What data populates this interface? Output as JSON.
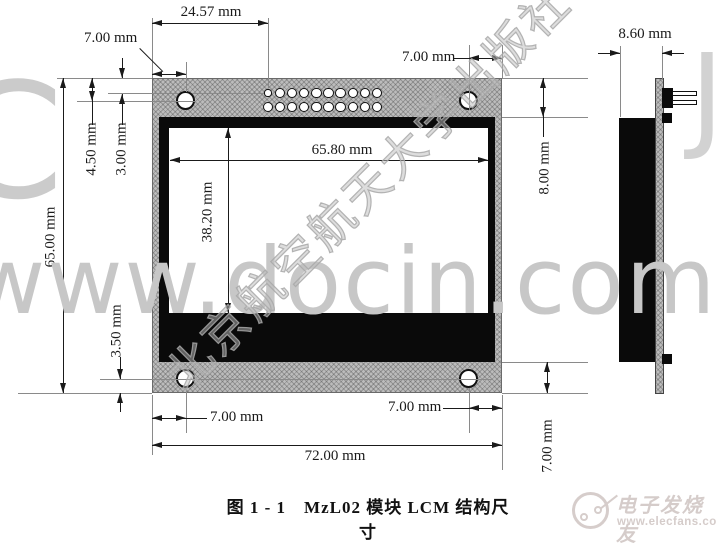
{
  "diagram": {
    "caption": "图 1 - 1　MzL02 模块 LCM 结构尺寸",
    "views": {
      "front": {
        "dims": {
          "pin_offset": "24.57 mm",
          "hole_inset_top_left": "7.00 mm",
          "edge_to_hole": "4.50 mm",
          "edge_to_pins": "3.00 mm",
          "module_height": "65.00 mm",
          "display_width": "65.80 mm",
          "display_height": "38.20 mm",
          "top_margin": "8.00 mm",
          "hole_inset_top_right": "7.00 mm",
          "hole_to_bottom": "3.50 mm",
          "hole_inset_bottom_left": "7.00 mm",
          "module_width": "72.00 mm",
          "hole_inset_bottom_right": "7.00 mm",
          "bottom_margin": "7.00 mm"
        },
        "pin_grid": {
          "rows": 2,
          "cols": 10
        },
        "mount_hole_count": 4
      },
      "side": {
        "dims": {
          "thickness": "8.60 mm"
        }
      }
    }
  },
  "watermarks": {
    "docin": "www.docin.com",
    "fragment_left": "C",
    "fragment_right": "J",
    "publisher": "北京航空航天大学出版社",
    "elecfans_name": "电子发烧友",
    "elecfans_url": "www.elecfans.com"
  }
}
